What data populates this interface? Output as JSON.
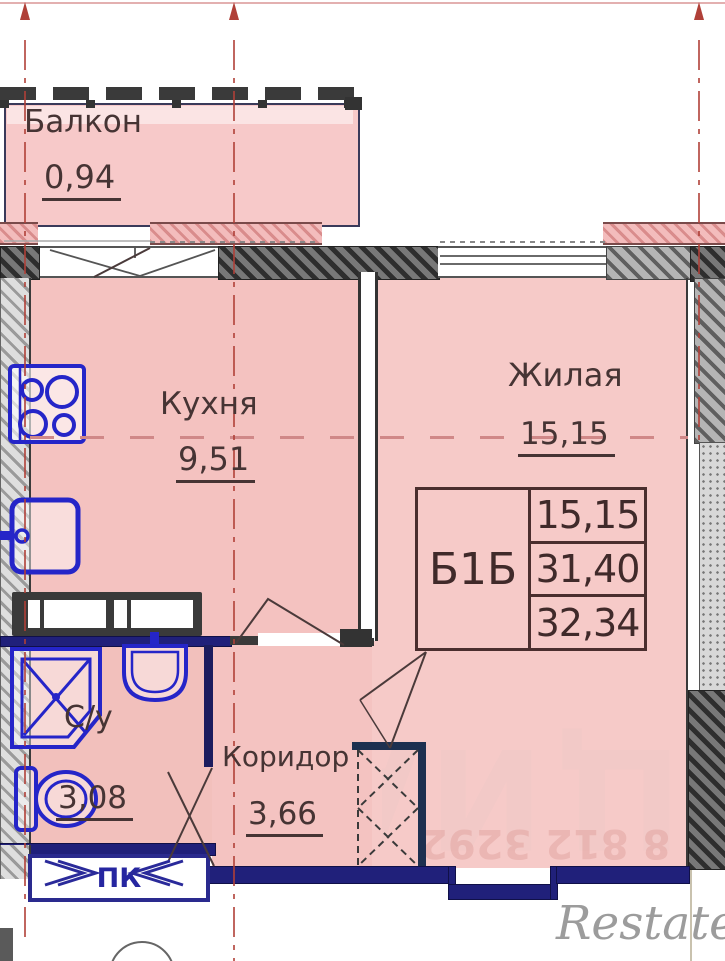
{
  "plan": {
    "title": "apartment-floor-plan",
    "rooms": [
      {
        "name": "Балкон",
        "area": "0,94"
      },
      {
        "name": "Кухня",
        "area": "9,51"
      },
      {
        "name": "Жилая",
        "area": "15,15"
      },
      {
        "name": "С/у",
        "area": "3,08"
      },
      {
        "name": "Коридор",
        "area": "3,66"
      }
    ],
    "info_table": {
      "unit_label": "Б1Б",
      "rows": [
        "15,15",
        "31,40",
        "32,34"
      ]
    },
    "labels": {
      "pk_window": "ПК"
    },
    "fixtures": [
      "stove-icon",
      "kitchen-sink-icon",
      "shower-icon",
      "washbasin-icon",
      "toilet-icon"
    ]
  },
  "watermarks": {
    "brand": "ЦИАН",
    "digits": "8 812 3292",
    "site": "Restate"
  },
  "colors": {
    "room_pink": "#f5c6c4",
    "exterior_wall_pink": "#f3bcbc",
    "wall_navy": "#20207a",
    "fixture_blue": "#2525c8",
    "axis_red": "#b04038",
    "text_brown": "#463434"
  }
}
